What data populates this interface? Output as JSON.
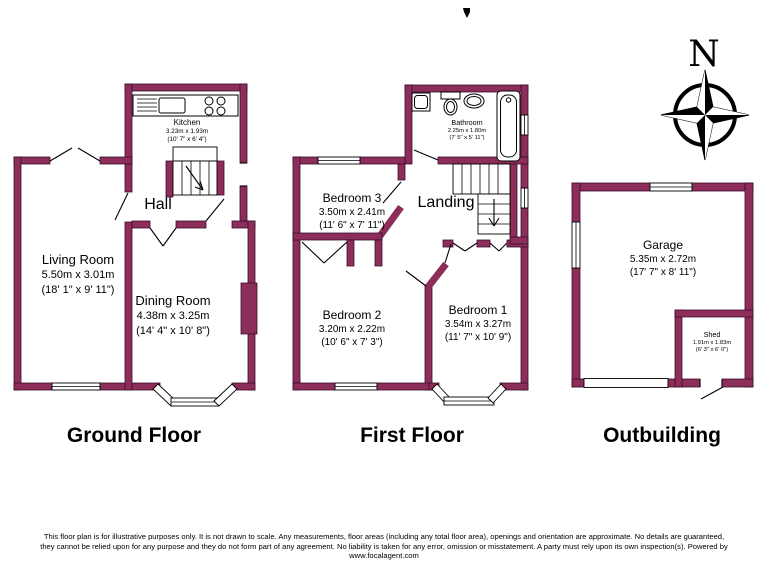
{
  "titles": {
    "ground": "Ground Floor",
    "first": "First Floor",
    "outbuilding": "Outbuilding"
  },
  "compass": {
    "north_label": "N"
  },
  "rooms": {
    "kitchen": {
      "name": "Kitchen",
      "metric": "3.23m x 1.93m",
      "imperial": "(10' 7\" x 6' 4\")"
    },
    "hall": {
      "name": "Hall"
    },
    "living_room": {
      "name": "Living Room",
      "metric": "5.50m x 3.01m",
      "imperial": "(18' 1\" x 9' 11\")"
    },
    "dining_room": {
      "name": "Dining Room",
      "metric": "4.38m x 3.25m",
      "imperial": "(14' 4\" x 10' 8\")"
    },
    "bathroom": {
      "name": "Bathroom",
      "metric": "2.25m x 1.80m",
      "imperial": "(7' 5\" x 5' 11\")"
    },
    "bedroom_3": {
      "name": "Bedroom 3",
      "metric": "3.50m x 2.41m",
      "imperial": "(11' 6\" x 7' 11\")"
    },
    "landing": {
      "name": "Landing"
    },
    "bedroom_2": {
      "name": "Bedroom 2",
      "metric": "3.20m x 2.22m",
      "imperial": "(10' 6\" x 7' 3\")"
    },
    "bedroom_1": {
      "name": "Bedroom 1",
      "metric": "3.54m x 3.27m",
      "imperial": "(11' 7\" x 10' 9\")"
    },
    "garage": {
      "name": "Garage",
      "metric": "5.35m x 2.72m",
      "imperial": "(17' 7\" x 8' 11\")"
    },
    "shed": {
      "name": "Shed",
      "metric": "1.91m x 1.83m",
      "imperial": "(6' 3\" x 6' 0\")"
    }
  },
  "disclaimer": {
    "line1": "This floor plan is for illustrative purposes only. It is not drawn to scale. Any measurements, floor areas (including any total floor area), openings and orientation are approximate. No details are guaranteed,",
    "line2": "they cannot be relied upon for any purpose and they do not form part of any agreement. No liability is taken for any error, omission or misstatement. A party must rely upon its own inspection(s). Powered by",
    "line3": "www.focalagent.com"
  },
  "colors": {
    "wall": "#8C2D5A",
    "wall_outline": "#3A0E2B",
    "background": "#FFFFFF",
    "line": "#000000"
  }
}
